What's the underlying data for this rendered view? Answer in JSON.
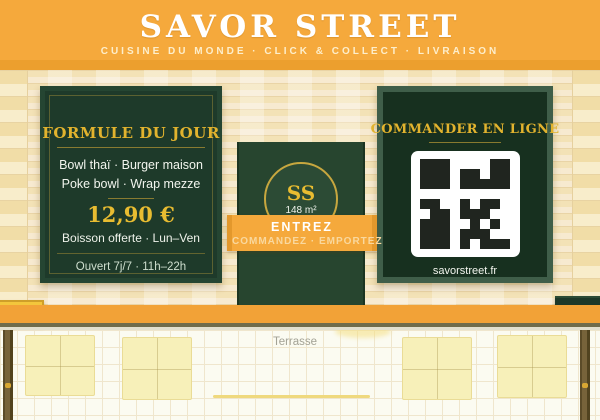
{
  "header": {
    "title": "SAVOR STREET",
    "subtitle": "CUISINE DU MONDE · CLICK & COLLECT · LIVRAISON"
  },
  "menu_sign": {
    "title": "FORMULE DU JOUR",
    "item1": "Bowl thaï · Burger maison",
    "item2": "Poke bowl · Wrap mezze",
    "price": "12,90 €",
    "note": "Boisson offerte · Lun–Ven",
    "hours": "Ouvert 7j/7 · 11h–22h"
  },
  "door": {
    "monogram": "SS",
    "area": "148 m²"
  },
  "entrez_banner": {
    "title": "ENTREZ",
    "subtitle": "COMMANDEZ · EMPORTEZ"
  },
  "online_sign": {
    "title": "COMMANDER EN LIGNE",
    "url": "savorstreet.fr",
    "qr_matrix": [
      [
        1,
        1,
        1,
        0,
        0,
        0,
        0,
        1,
        1
      ],
      [
        1,
        1,
        1,
        0,
        1,
        1,
        0,
        1,
        1
      ],
      [
        1,
        1,
        1,
        0,
        1,
        1,
        1,
        1,
        1
      ],
      [
        0,
        0,
        0,
        0,
        0,
        0,
        0,
        0,
        0
      ],
      [
        1,
        1,
        0,
        0,
        1,
        0,
        1,
        1,
        0
      ],
      [
        0,
        1,
        1,
        0,
        1,
        1,
        1,
        0,
        0
      ],
      [
        1,
        1,
        1,
        0,
        0,
        1,
        0,
        1,
        0
      ],
      [
        1,
        1,
        1,
        0,
        1,
        1,
        1,
        0,
        0
      ],
      [
        1,
        1,
        1,
        0,
        1,
        0,
        1,
        1,
        1
      ]
    ]
  },
  "small_signs": {
    "left": "OUVERT",
    "right": "11h - 22h"
  },
  "terrace": {
    "label": "Terrasse"
  },
  "colors": {
    "accent_orange": "#f5a93c",
    "sign_green": "#1e3a2a",
    "gold": "#e2b32e",
    "wall_cream": "#f5e5be"
  }
}
